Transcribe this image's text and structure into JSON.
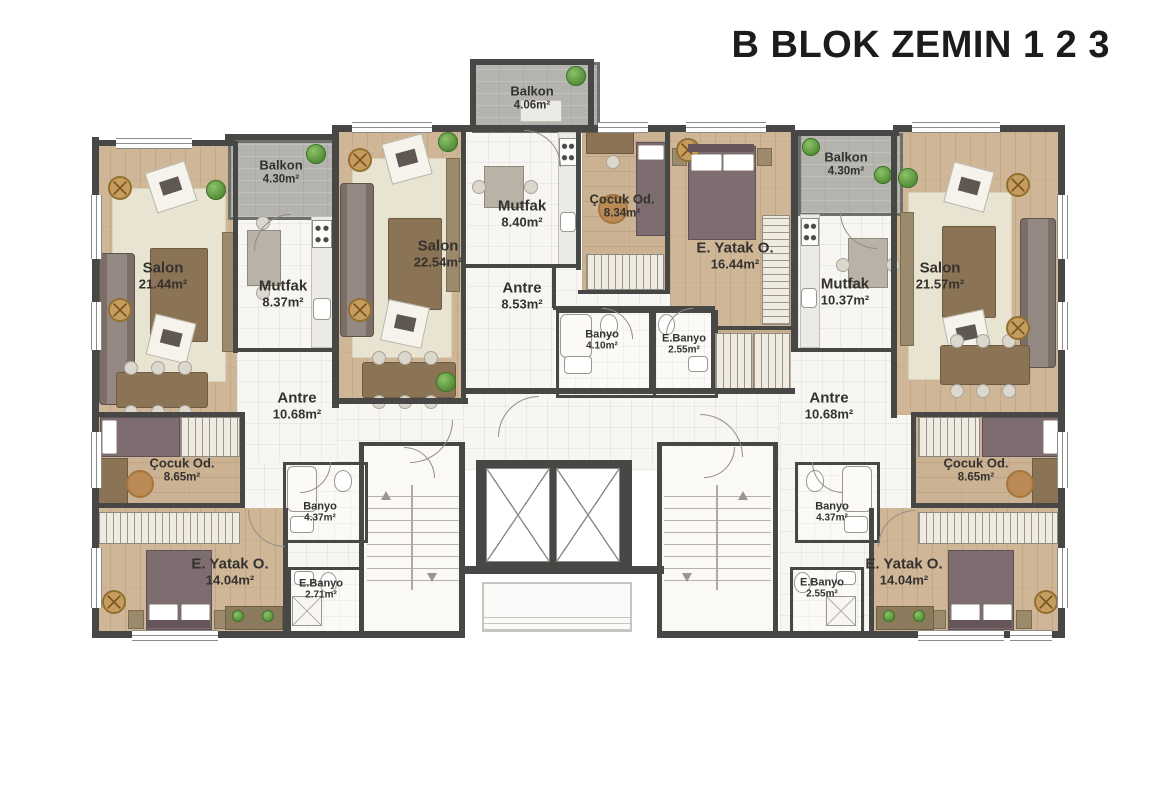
{
  "title": "B BLOK ZEMIN 1 2 3",
  "colors": {
    "wall": "#474745",
    "wood_floor": "#cfb697",
    "tile_floor": "#f7f6f2",
    "balcony": "#b4b3ae",
    "plant_green": "#4f8a35",
    "fan_wood": "#c79d5f",
    "furniture_brown": "#8b7355",
    "bed_fabric": "#7d6c70"
  },
  "rooms": {
    "left_balkon": {
      "name": "Balkon",
      "area": "4.30m²"
    },
    "left_salon": {
      "name": "Salon",
      "area": "21.44m²"
    },
    "left_mutfak": {
      "name": "Mutfak",
      "area": "8.37m²"
    },
    "left_antre": {
      "name": "Antre",
      "area": "10.68m²"
    },
    "left_cocuk": {
      "name": "Çocuk Od.",
      "area": "8.65m²"
    },
    "left_banyo": {
      "name": "Banyo",
      "area": "4.37m²"
    },
    "left_eyatak": {
      "name": "E. Yatak O.",
      "area": "14.04m²"
    },
    "left_ebanyo": {
      "name": "E.Banyo",
      "area": "2.71m²"
    },
    "center_balkon": {
      "name": "Balkon",
      "area": "4.06m²"
    },
    "center_salon": {
      "name": "Salon",
      "area": "22.54m²"
    },
    "center_mutfak": {
      "name": "Mutfak",
      "area": "8.40m²"
    },
    "center_cocuk": {
      "name": "Çocuk Od.",
      "area": "8.34m²"
    },
    "center_eyatak": {
      "name": "E. Yatak O.",
      "area": "16.44m²"
    },
    "center_antre": {
      "name": "Antre",
      "area": "8.53m²"
    },
    "center_banyo": {
      "name": "Banyo",
      "area": "4.10m²"
    },
    "center_ebanyo": {
      "name": "E.Banyo",
      "area": "2.55m²"
    },
    "right_balkon": {
      "name": "Balkon",
      "area": "4.30m²"
    },
    "right_mutfak": {
      "name": "Mutfak",
      "area": "10.37m²"
    },
    "right_salon": {
      "name": "Salon",
      "area": "21.57m²"
    },
    "right_antre": {
      "name": "Antre",
      "area": "10.68m²"
    },
    "right_cocuk": {
      "name": "Çocuk Od.",
      "area": "8.65m²"
    },
    "right_banyo": {
      "name": "Banyo",
      "area": "4.37m²"
    },
    "right_eyatak": {
      "name": "E. Yatak O.",
      "area": "14.04m²"
    },
    "right_ebanyo": {
      "name": "E.Banyo",
      "area": "2.55m²"
    }
  }
}
